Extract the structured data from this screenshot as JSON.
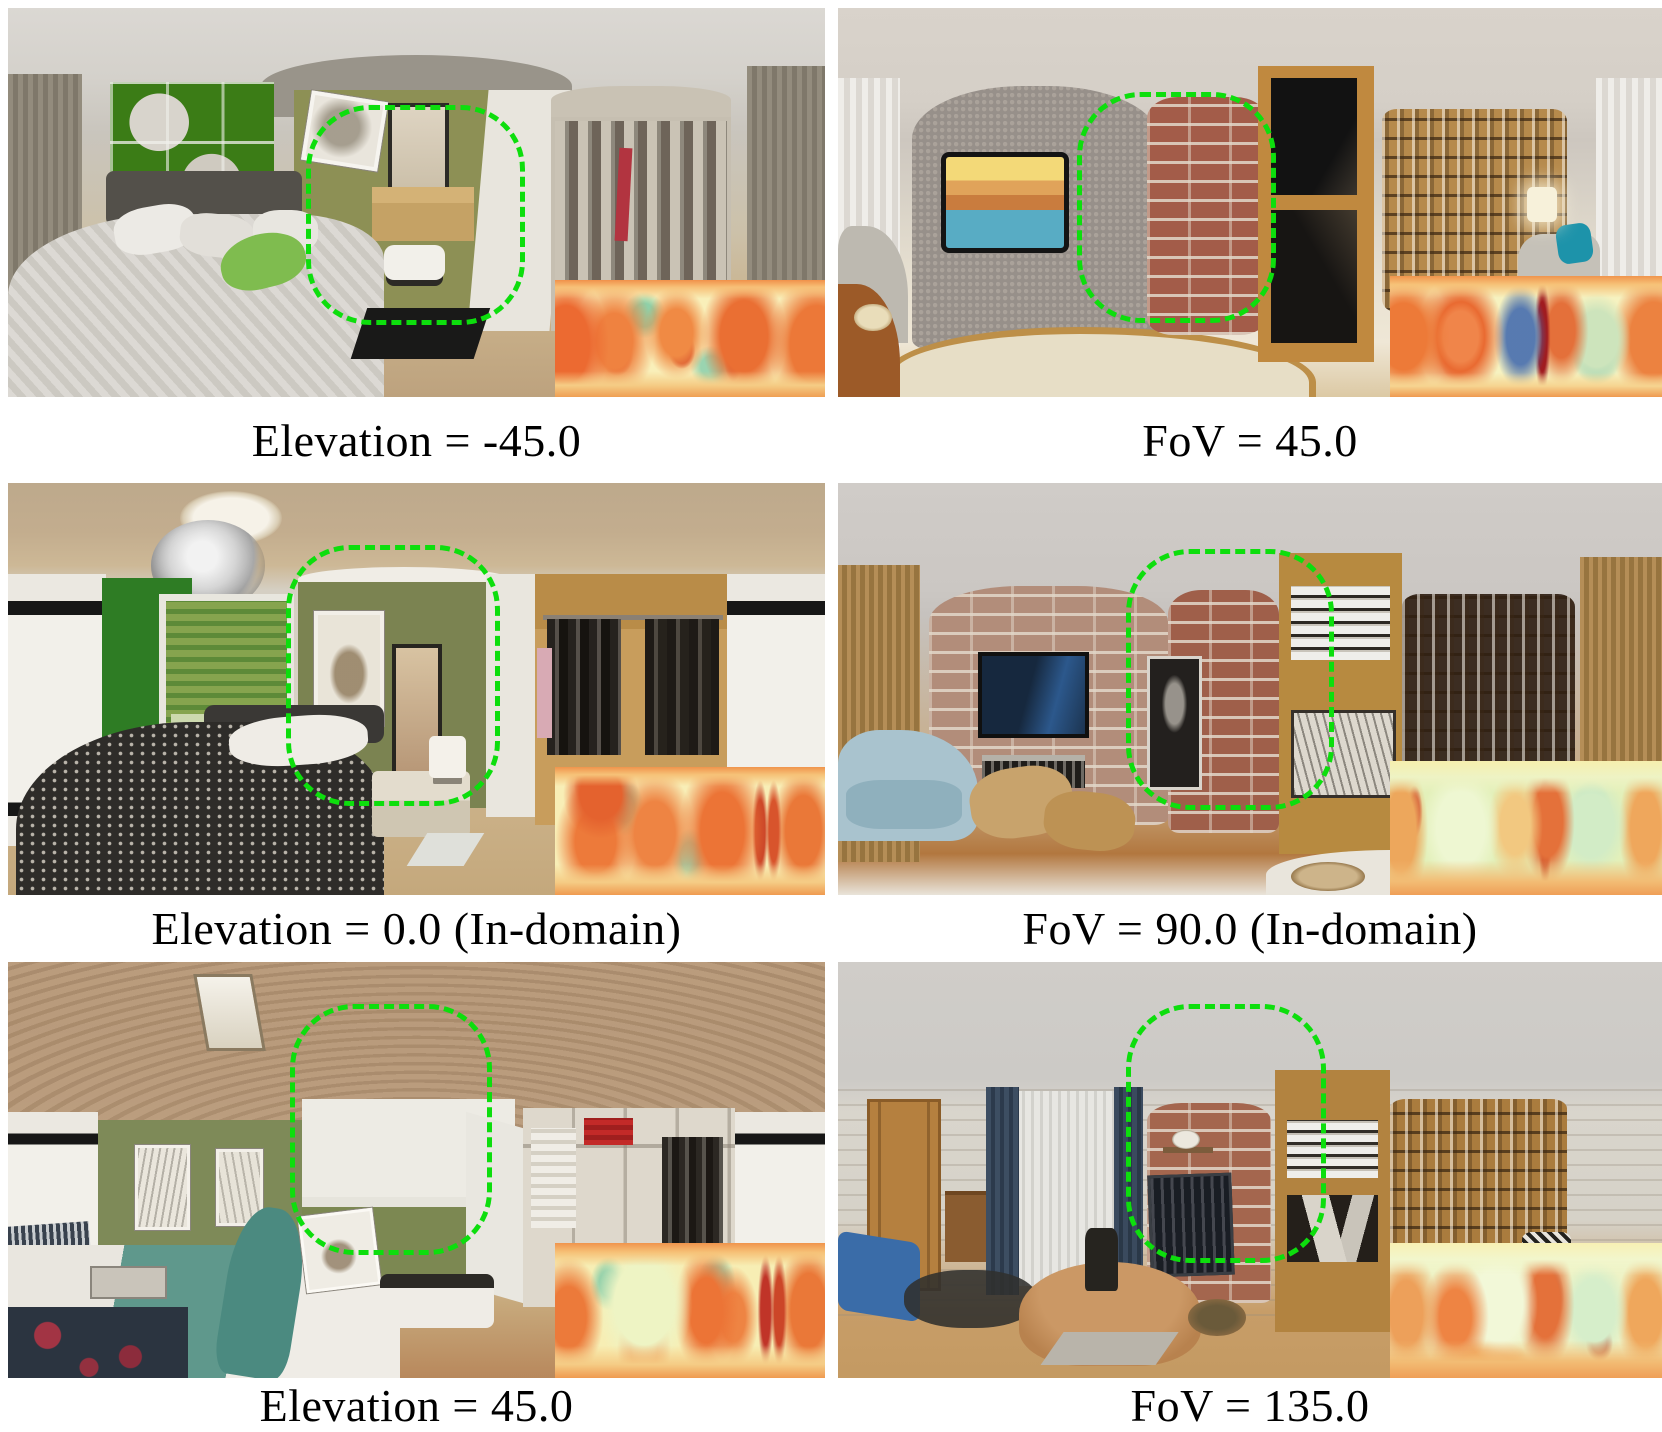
{
  "figure": {
    "background_color": "#ffffff",
    "caption_color": "#000000",
    "highlight": {
      "color": "#0dde0d",
      "style": "dashed",
      "shape": "rounded-rectangle"
    },
    "depth_map_palette": [
      "#f9efb9",
      "#ef8240",
      "#d6452a",
      "#8fd0a8",
      "#3c63aa"
    ],
    "panels": [
      {
        "caption": "Elevation = -45.0",
        "scene": "bedroom panorama: green shelving unit, olive wall with mirror and desk, bed with pillows, wardrobe with hanging clothes, gray curtains",
        "has_highlight_box": true,
        "has_depth_map_inset": true
      },
      {
        "caption": "FoV = 45.0",
        "scene": "living room panorama: gray textured wall with TV showing canal scene, red brick column, wooden cabinet, bookshelf, white curtains, patterned rug",
        "has_highlight_box": true,
        "has_depth_map_inset": true
      },
      {
        "caption": "Elevation = 0.0 (In-domain)",
        "scene": "bedroom panorama: ceiling light and chandelier, green wall with blinds, olive wall with deer picture and mirror, dark patterned bed, open closet with clothes",
        "has_highlight_box": true,
        "has_depth_map_inset": true
      },
      {
        "caption": "FoV = 90.0 (In-domain)",
        "scene": "living room panorama: pink brick wall with TV and fireplace, red brick column with portrait, wooden shelf with binders, dark bookshelf, blue sofa, bamboo curtains",
        "has_highlight_box": true,
        "has_depth_map_inset": true
      },
      {
        "caption": "Elevation = 45.0",
        "scene": "bedroom panorama: large swirled tan ceiling, olive walls with framed sketches, white alcove wall, closet with red folded clothes, bed with teal blanket, dark patterned rug",
        "has_highlight_box": true,
        "has_depth_map_inset": true
      },
      {
        "caption": "FoV = 135.0",
        "scene": "study panorama: whitewashed brick walls, wooden door, window with blue drapes, red brick wall with clock and TV, wooden bookshelves, blue bench, wooden table",
        "has_highlight_box": true,
        "has_depth_map_inset": true
      }
    ]
  }
}
